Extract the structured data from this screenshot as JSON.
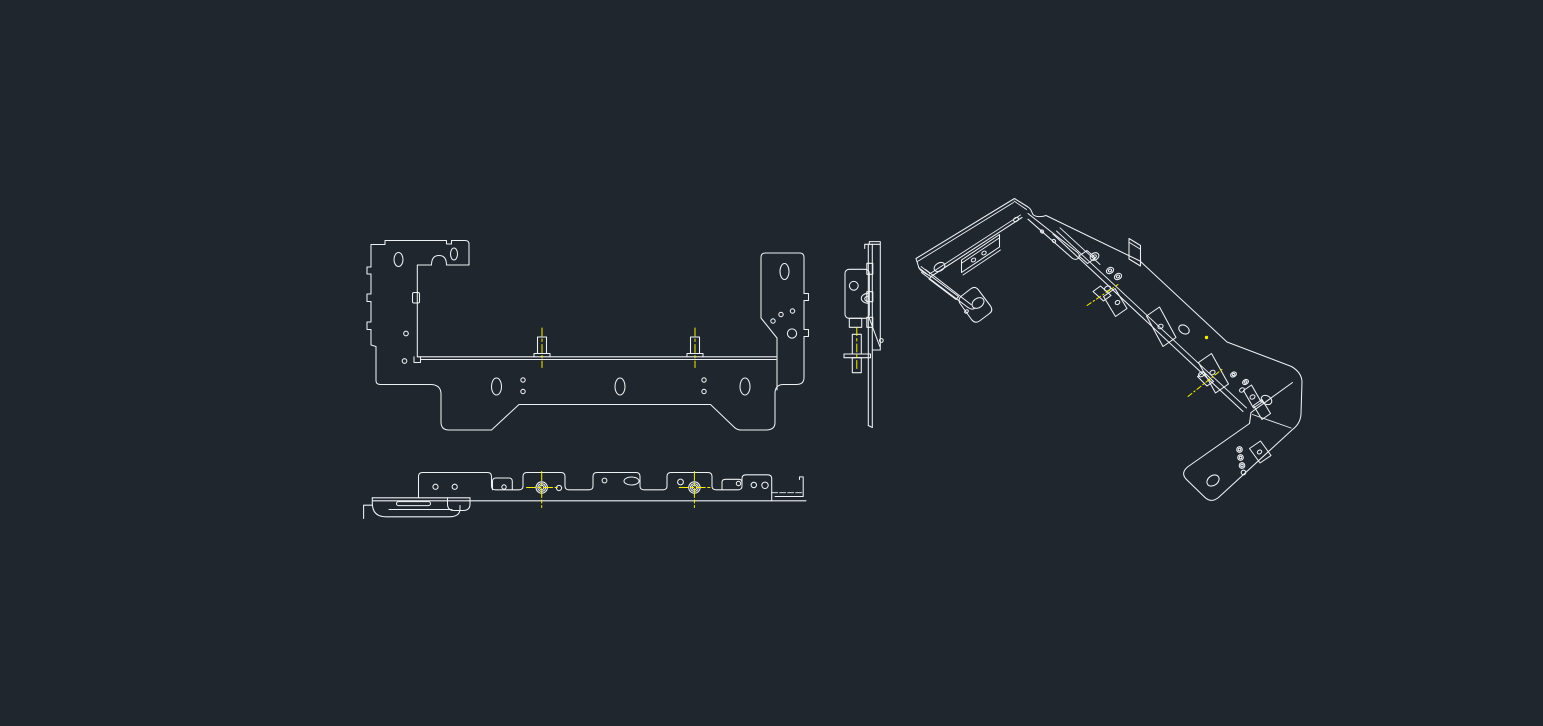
{
  "viewport": {
    "background_color": "#20262e",
    "line_color": "#eef1f4",
    "centerline_color": "#f6ef02",
    "width_px": 1543,
    "height_px": 726
  },
  "views": [
    {
      "id": "front-view",
      "label": "Front orthographic view of sheet-metal bracket",
      "stud_count": 2,
      "centerline_count": 2,
      "slot_hole_count": 3
    },
    {
      "id": "top-view",
      "label": "Top orthographic view of sheet-metal bracket",
      "stud_count": 2,
      "centerline_count": 2
    },
    {
      "id": "side-view",
      "label": "Side orthographic view of sheet-metal bracket",
      "stud_count": 1,
      "centerline_count": 1
    },
    {
      "id": "isometric-view",
      "label": "Isometric view of sheet-metal bracket",
      "stud_count": 2,
      "centerline_count": 2
    }
  ]
}
